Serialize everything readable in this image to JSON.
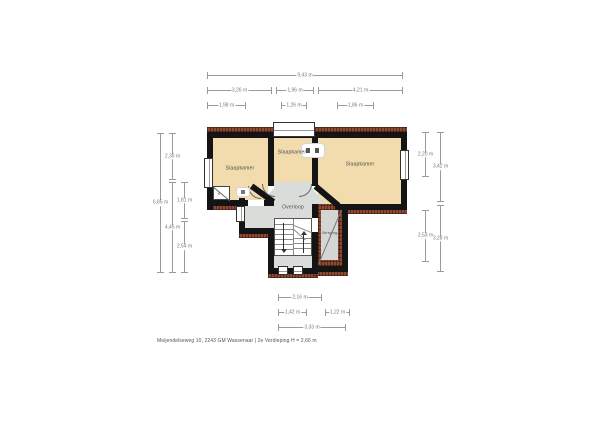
{
  "caption": "Meijendelseweg 10, 2243 GM Wassenaar | 2e Verdieping H = 2,66 m",
  "rooms": {
    "left_bedroom": "Slaapkamer",
    "middle_bedroom": "Slaapkamer",
    "right_bedroom": "Slaapkamer",
    "landing": "Overloop",
    "storage": "Berging",
    "closet": "K"
  },
  "dims": {
    "top_total": "9,43 m",
    "top_row2_left": "3,26 m",
    "top_row2_middle": "1,96 m",
    "top_row2_right": "4,21 m",
    "top_row3_left": "1,98 m",
    "top_row3_middle": "1,26 m",
    "top_row3_right": "1,86 m",
    "left_outer": "6,85 m",
    "left_mid_upper": "2,30 m",
    "left_mid_lower": "4,45 m",
    "left_inner_upper": "1,81 m",
    "left_inner_lower": "2,54 m",
    "right_inner_upper": "2,20 m",
    "right_inner_lower": "2,53 m",
    "right_outer_upper": "3,42 m",
    "right_outer_lower": "3,28 m",
    "bottom_row1": "2,16 m",
    "bottom_row2_left": "1,42 m",
    "bottom_row2_right": "1,22 m",
    "bottom_row3": "3,33 m"
  },
  "colors": {
    "wall": "#141414",
    "room_fill": "#f2dcae",
    "hall_fill": "#d9dcd8",
    "balcony_inner": "#d3d6d2",
    "brick": "#8a4a33",
    "dim_line": "#9a9a9a",
    "label_text": "#4a4a4a"
  }
}
